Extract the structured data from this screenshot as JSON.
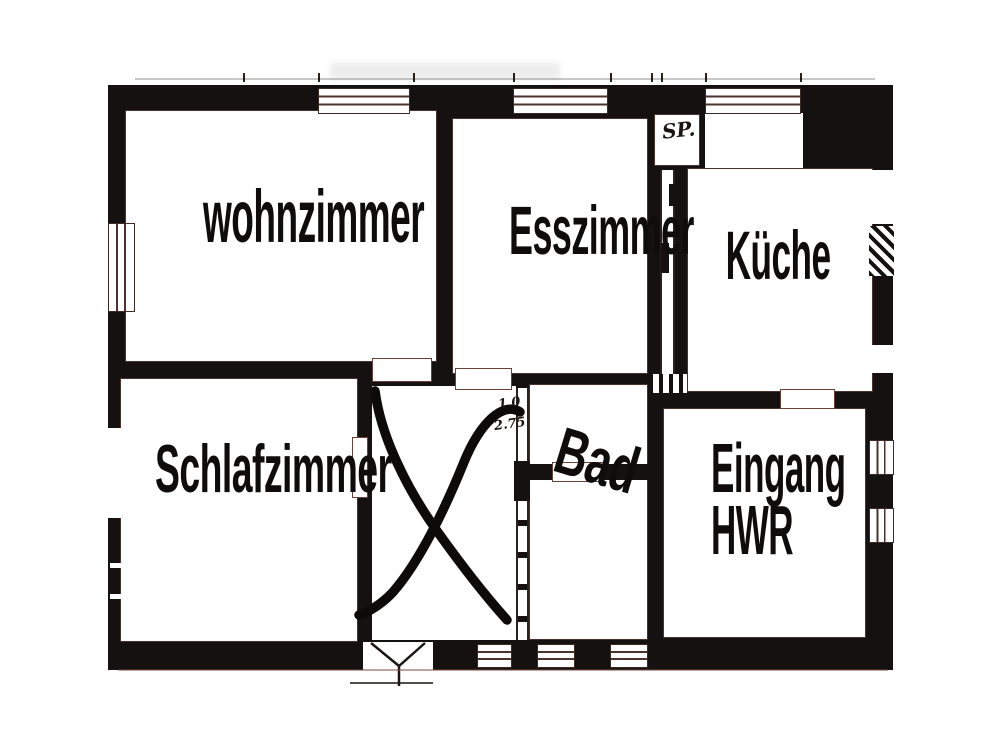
{
  "document_type": "apartment floor plan (scanned, black and white)",
  "plan": {
    "rooms": [
      {
        "id": "wohnzimmer",
        "label": "wohnzimmer"
      },
      {
        "id": "esszimmer",
        "label": "Esszimmer"
      },
      {
        "id": "kueche",
        "label": "Küche"
      },
      {
        "id": "schlafzimmer",
        "label": "Schlafzimmer"
      },
      {
        "id": "bad",
        "label": "Bad"
      },
      {
        "id": "eingang-hwr",
        "label": "Eingang",
        "label_line2": "HWR"
      },
      {
        "id": "speisekammer",
        "label": "SP."
      }
    ],
    "annotations": {
      "dim_top": "1.0",
      "dim_bottom": "2.75",
      "x_mark": "hand-drawn X crossing out the hallway room"
    },
    "colors": {
      "ink": "#141110",
      "paper": "#ffffff",
      "detail_line": "#4a332d"
    }
  }
}
